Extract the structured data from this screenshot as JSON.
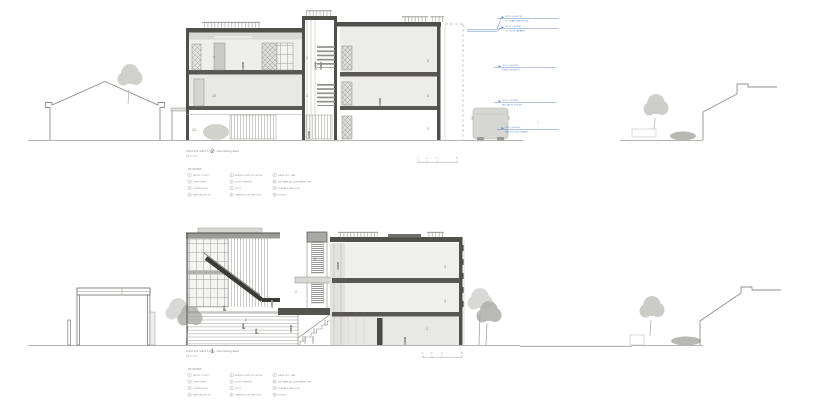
{
  "sheet": {
    "background": "#ffffff"
  },
  "palette": {
    "wall_dark": "#4f4f4c",
    "fill_light": "#ececea",
    "fill_mid": "#d9d9d6",
    "figure_gray": "#90908a",
    "tree_gray": "#c5c5c1",
    "annotation_blue": "#4d7cbe"
  },
  "scalebar": {
    "zero": "0",
    "two": "2'",
    "four": "4'",
    "eight": "8'"
  },
  "legend": {
    "header": "KEYNOTES",
    "columns": [
      [
        {
          "num": "1",
          "label": "ENTRY COURT"
        },
        {
          "num": "2",
          "label": "OPEN STAIR"
        },
        {
          "num": "3",
          "label": "CLASSROOM"
        },
        {
          "num": "4",
          "label": "MEETING ROOM"
        }
      ],
      [
        {
          "num": "5",
          "label": "ADMINISTRATION OFFICE"
        },
        {
          "num": "6",
          "label": "STOR. GARAGE"
        },
        {
          "num": "7",
          "label": "DECK"
        },
        {
          "num": "8",
          "label": "GREEN ROOF (BEYOND)"
        }
      ],
      [
        {
          "num": "9",
          "label": "CARPORT / LAB"
        },
        {
          "num": "10",
          "label": "MECHANICAL EQUIPMENT RM."
        },
        {
          "num": "11",
          "label": "TERRACE (BEYOND)"
        },
        {
          "num": "12",
          "label": "STUDIO"
        }
      ]
    ]
  },
  "sections": {
    "top": {
      "title_prefix": "CROSS SECTION",
      "number": "2",
      "subtitle": "view facing East",
      "scale": "1/8\" = 1'-0\"",
      "property_line_label": "P.L.",
      "rooms": {
        "r4": "4",
        "r10": "10",
        "r12": "12",
        "core_up": "2",
        "core_low": "2",
        "rt_top": "3",
        "rt_mid": "3",
        "rt_ground": "3"
      },
      "elevations": [
        {
          "l1": "+35'-0\" (+10.67 M)",
          "l2": "T.O. STAIR PENTHOUSE"
        },
        {
          "l1": "+31'-6\" (+9.60 M)",
          "l2": "T.O. ROOF PARAPET"
        },
        {
          "l1": "+21'-0\" (+6.40 M)",
          "l2": "THIRD FLOOR F.F."
        },
        {
          "l1": "+10'-6\" (+3.20 M)",
          "l2": "SECOND FLOOR F.F."
        },
        {
          "l1": "+0'-0\" (+0.00 M)",
          "l2": "FIRST FLOOR / GRADE"
        }
      ]
    },
    "bottom": {
      "title_prefix": "CROSS SECTION",
      "number": "1",
      "subtitle": "view facing East",
      "scale": "1/8\" = 1'-0\"",
      "rooms": {
        "bleacher": "2",
        "bridge": "2",
        "landing": "2",
        "top": "3",
        "mid": "3",
        "ground": "1"
      }
    }
  }
}
